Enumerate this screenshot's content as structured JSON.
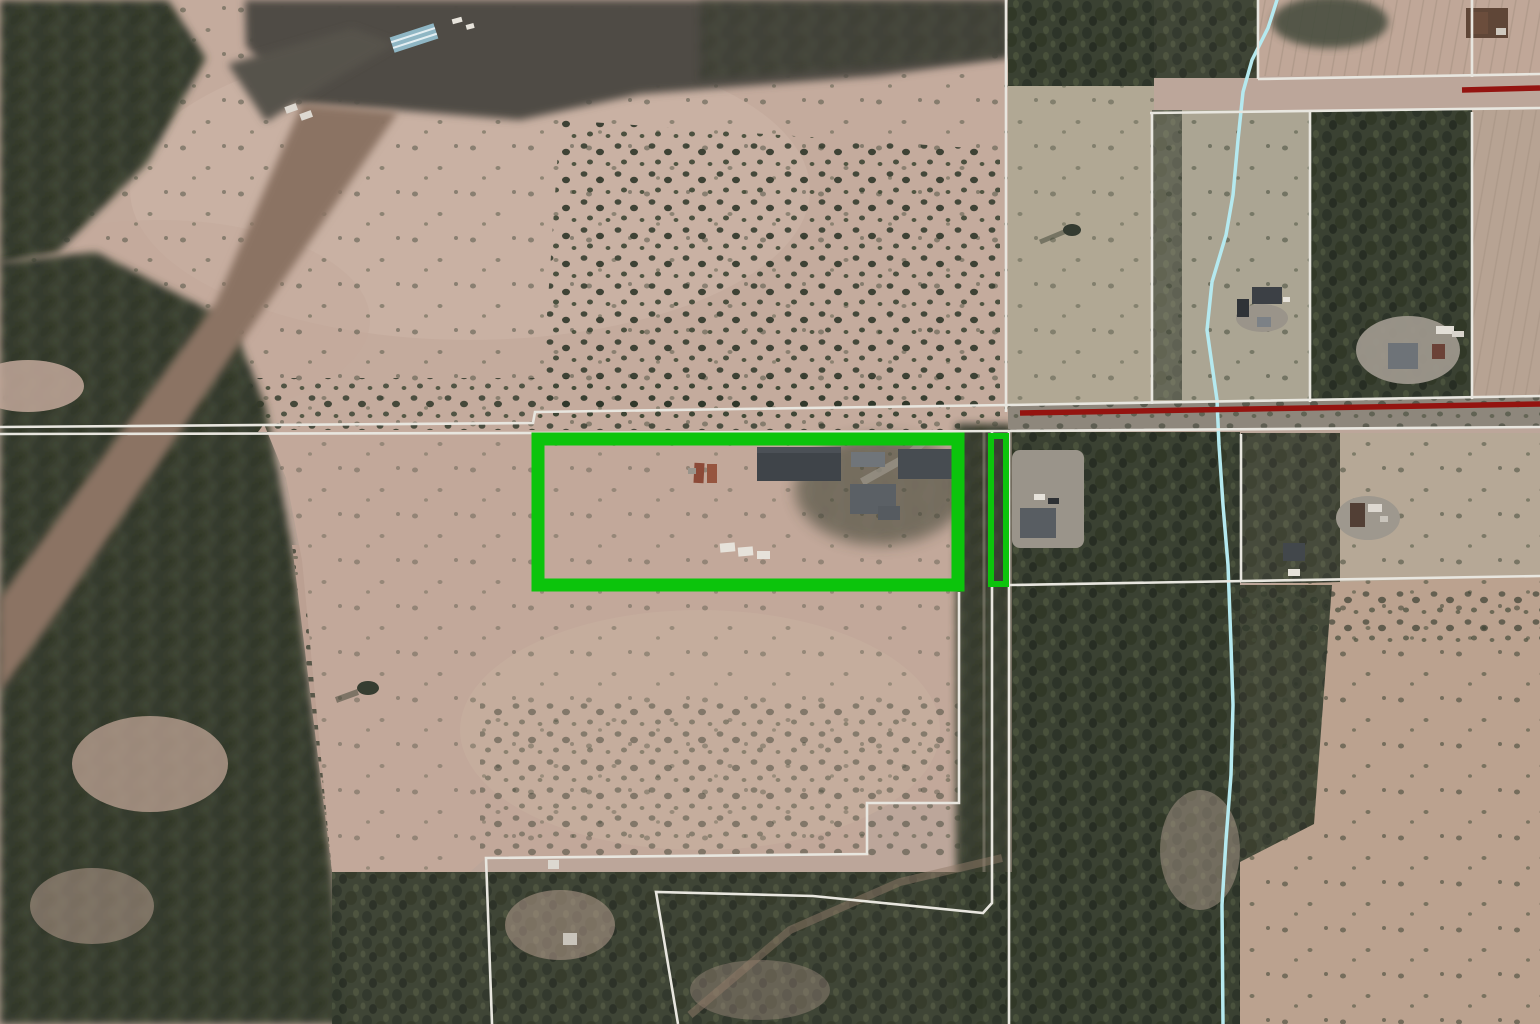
{
  "map": {
    "view": "aerial-parcel-map",
    "description": "Satellite/aerial GIS view with white parcel boundary lines, a dark-red road centerline, a light-cyan stream line, and a bright green highlight outlining a subject parcel plus a narrow road-corridor strip.",
    "colors": {
      "parcel_line": "#e8e6df",
      "road_line": "#941410",
      "stream": "#b5e9ef",
      "highlight": "#0cc40c"
    },
    "overlays": {
      "parcel_lines": [
        {
          "id": "section-line-north-of-road",
          "points": "0,427 533,423 535,412 1008,405 1540,396"
        },
        {
          "id": "road-south-line",
          "points": "0,434 535,433 1008,431 1540,427"
        },
        {
          "id": "corridor-west-line-upper",
          "points": "1006,0 1006,412"
        },
        {
          "id": "vertical-line-1152",
          "points": "1152,112 1152,404"
        },
        {
          "id": "horizontal-line-112",
          "points": "1150,113 1540,108"
        },
        {
          "id": "horizontal-line-77",
          "points": "1258,79 1540,74"
        },
        {
          "id": "vertical-line-1258-top",
          "points": "1258,0 1258,79"
        },
        {
          "id": "vertical-line-1472-top",
          "points": "1472,0 1472,77"
        },
        {
          "id": "vertical-line-1472-lower",
          "points": "1472,112 1472,399"
        },
        {
          "id": "vertical-line-1310",
          "points": "1310,112 1310,402"
        },
        {
          "id": "south-parcel-line-585",
          "points": "1010,585 1540,576"
        },
        {
          "id": "stepped-boundary-west",
          "points": "959,592 959,803 867,803 867,854 486,858 492,1024"
        },
        {
          "id": "corridor-west-line-lower",
          "points": "992,432 992,903 983,913 813,896 656,892 678,1024"
        },
        {
          "id": "corridor-east-line-lower",
          "points": "1009,432 1009,1024"
        },
        {
          "id": "vertical-line-1241",
          "points": "1241,434 1241,581"
        }
      ],
      "road_lines": [
        {
          "id": "road-centerline-main",
          "points": "1020,413 1540,404"
        },
        {
          "id": "road-centerline-top-right",
          "points": "1462,90 1540,88"
        }
      ],
      "stream": {
        "id": "stream-line",
        "points": "1277,0 1268,28 1252,60 1243,92 1238,140 1233,195 1226,235 1212,282 1207,330 1213,372 1217,400 1219,445 1223,505 1228,565 1231,645 1233,705 1231,775 1226,840 1222,905 1223,1024"
      },
      "highlight_parcels": [
        {
          "id": "subject-parcel-outline",
          "points": "538,439 958,439 958,585 538,585"
        },
        {
          "id": "corridor-strip-outline",
          "points": "991,436 1006,436 1006,584 991,584"
        }
      ]
    }
  }
}
